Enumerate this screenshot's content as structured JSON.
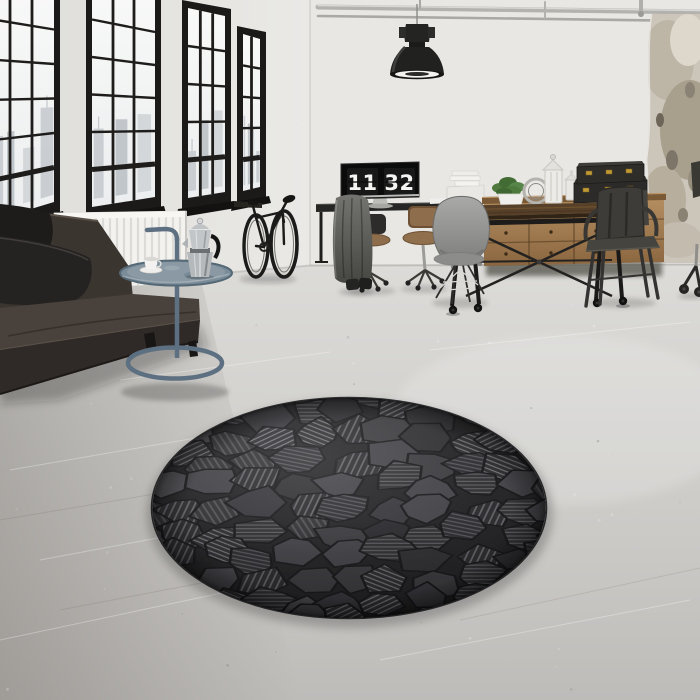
{
  "meta": {
    "kind": "photograph",
    "description": "Bright industrial loft interior: black steel factory windows with city view, dark leather sofa, blue-grey tubular side table with moka pot and cup, bicycle against the wall, industrial pendant lamp, desk with a monitor showing a flip clock, wooden drawer sideboard with black trunks, plant and lanterns, industrial dining table with metal chairs, and a round charcoal geometric-mosaic rug centered on a polished concrete floor."
  },
  "clock": {
    "hours": "11",
    "minutes": "32"
  },
  "rug": {
    "shape": "round",
    "pattern": "geometric mosaic facets with ribbed pile",
    "color_name": "charcoal black"
  },
  "objects": [
    "factory-windows",
    "radiator",
    "leather-sofa",
    "throw-pillows",
    "side-table",
    "moka-pot",
    "coffee-cup",
    "bicycle",
    "bike-rack",
    "pendant-lamp",
    "ceiling-pipes",
    "desk",
    "monitor-flip-clock",
    "office-chairs",
    "coat-jacket",
    "boots",
    "printer-cabinet",
    "paper-stack",
    "sideboard",
    "storage-trunks",
    "potted-plant",
    "lanterns",
    "decorative-ring",
    "dining-table",
    "shell-chair",
    "metal-armchair",
    "partial-office-chair",
    "round-mosaic-rug",
    "concrete-floor",
    "plaster-patch"
  ],
  "palette": {
    "wall": "#e8e7e4",
    "left_wall": "#e2e1de",
    "floor_light": "#dbdad7",
    "floor_dark": "#bfbdba",
    "window_frame": "#1c1a18",
    "glass": "#f6f7f6",
    "skyline": "#c7cbcf",
    "radiator": "#f3f2ef",
    "sofa_leather": "#49413b",
    "sofa_base": "#2f2a27",
    "pillow": "#252322",
    "side_table": "#5d7081",
    "tray": "#7b8c99",
    "metal_silver": "#bcbfc1",
    "bike": "#1b1b1a",
    "lamp": "#212120",
    "desk": "#262624",
    "screen": "#0b0b0b",
    "digits": "#f4f4f2",
    "wood_table": "#56402a",
    "sideboard_wood": "#ac855a",
    "trunk": "#2c2b29",
    "brass": "#c09b35",
    "plant": "#4e7a3e",
    "chair_grey": "#909090",
    "chair_metal": "#3d3c38",
    "plaster_patch": "#ccc5ba",
    "pipes": "#b3b2af",
    "rug_base": "#1e1e20",
    "rug_facet_dark": "#2b2b2e",
    "rug_facet_mid": "#37373b",
    "rug_facet_light": "#46464b",
    "rug_stripe": "#64646a",
    "rug_groove": "#141417"
  }
}
